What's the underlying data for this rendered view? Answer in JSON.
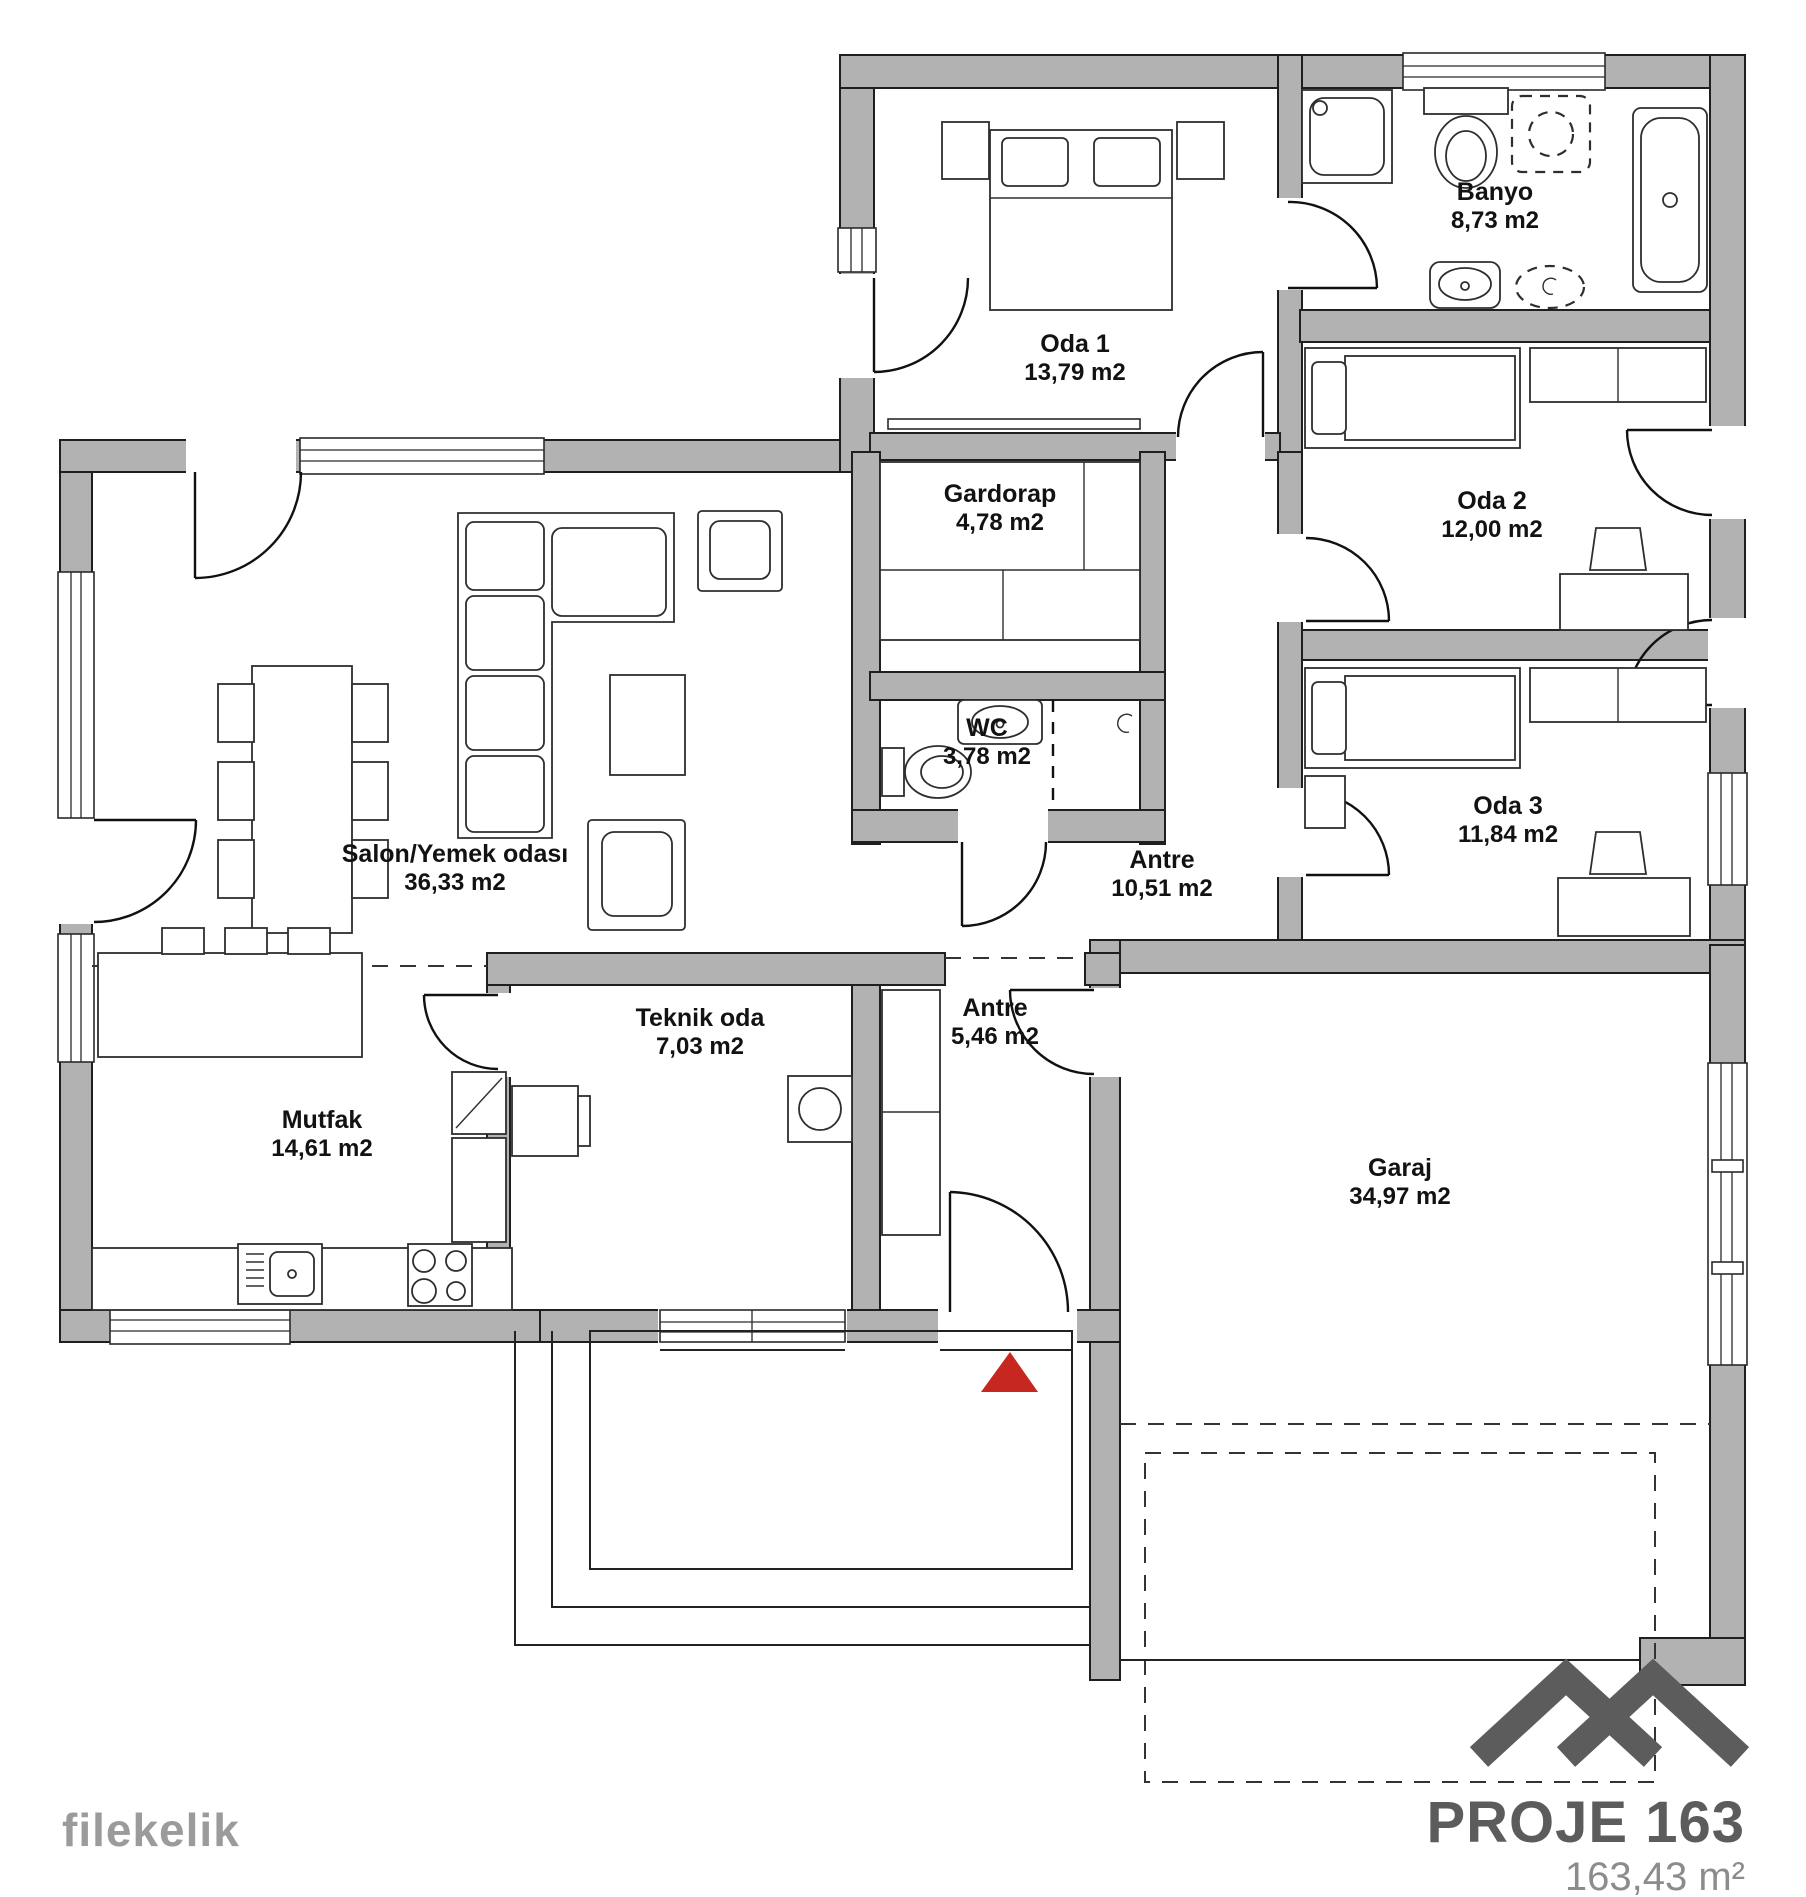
{
  "branding": {
    "watermark": "filekelik",
    "project_name": "PROJE 163",
    "total_area": "163,43 m²"
  },
  "rooms": [
    {
      "id": "oda-1",
      "name": "Oda 1",
      "area": "13,79 m2"
    },
    {
      "id": "banyo",
      "name": "Banyo",
      "area": "8,73 m2"
    },
    {
      "id": "gardorap",
      "name": "Gardorap",
      "area": "4,78 m2"
    },
    {
      "id": "wc",
      "name": "WC",
      "area": "3,78 m2"
    },
    {
      "id": "oda-2",
      "name": "Oda 2",
      "area": "12,00 m2"
    },
    {
      "id": "oda-3",
      "name": "Oda 3",
      "area": "11,84 m2"
    },
    {
      "id": "salon",
      "name": "Salon/Yemek odası",
      "area": "36,33 m2"
    },
    {
      "id": "antre-ust",
      "name": "Antre",
      "area": "10,51 m2"
    },
    {
      "id": "mutfak",
      "name": "Mutfak",
      "area": "14,61 m2"
    },
    {
      "id": "teknik",
      "name": "Teknik oda",
      "area": "7,03 m2"
    },
    {
      "id": "antre-alt",
      "name": "Antre",
      "area": "5,46 m2"
    },
    {
      "id": "garaj",
      "name": "Garaj",
      "area": "34,97 m2"
    }
  ],
  "entrance_marker": {
    "shape": "triangle-up",
    "color": "#c62721"
  },
  "colors": {
    "wall_fill": "#b2b2b2",
    "line": "#1f1f1f",
    "brand_dark": "#5c5c5c",
    "brand_light": "#8c8c8c",
    "watermark_gray": "#9b9b9b"
  }
}
